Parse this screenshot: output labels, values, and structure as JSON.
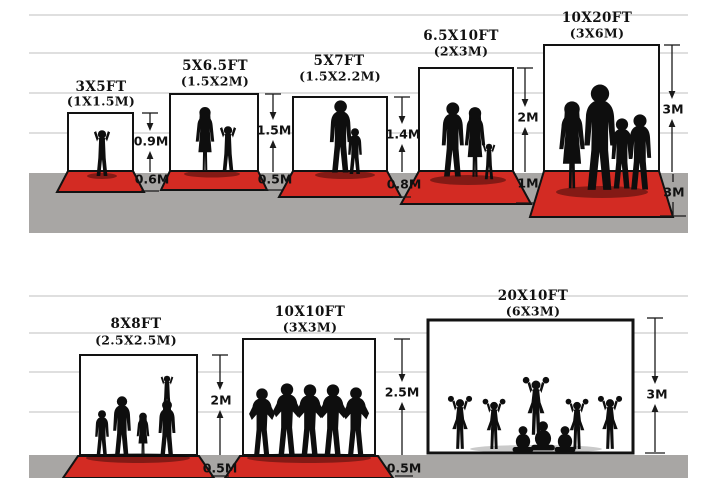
{
  "diagram": {
    "title": "Backdrop size comparison",
    "rows": [
      {
        "panels": [
          {
            "ft": "3X5FT",
            "m": "(1X1.5M)",
            "height": "0.9M",
            "floor": "0.6M",
            "figures": "toddler-silhouette"
          },
          {
            "ft": "5X6.5FT",
            "m": "(1.5X2M)",
            "height": "1.5M",
            "floor": "0.5M",
            "figures": "mother-and-child-silhouette"
          },
          {
            "ft": "5X7FT",
            "m": "(1.5X2.2M)",
            "height": "1.4M",
            "floor": "0.8M",
            "figures": "father-and-son-silhouette"
          },
          {
            "ft": "6.5X10FT",
            "m": "(2X3M)",
            "height": "2M",
            "floor": "1M",
            "figures": "couple-with-child-silhouette"
          },
          {
            "ft": "10X20FT",
            "m": "(3X6M)",
            "height": "3M",
            "floor": "3M",
            "figures": "family-of-four-silhouette"
          }
        ]
      },
      {
        "panels": [
          {
            "ft": "8X8FT",
            "m": "(2.5X2.5M)",
            "height": "2M",
            "floor": "0.5M",
            "figures": "family-group-silhouette"
          },
          {
            "ft": "10X10FT",
            "m": "(3X3M)",
            "height": "2.5M",
            "floor": "0.5M",
            "figures": "sports-team-silhouette"
          },
          {
            "ft": "20X10FT",
            "m": "(6X3M)",
            "height": "3M",
            "floor": null,
            "figures": "cheerleaders-silhouette"
          }
        ]
      }
    ],
    "colors": {
      "carpet_red": "#d32b23",
      "ground_gray": "#a8a6a4",
      "gridline_gray": "#cccccc",
      "ink_black": "#121212",
      "backdrop_white": "#ffffff"
    }
  }
}
